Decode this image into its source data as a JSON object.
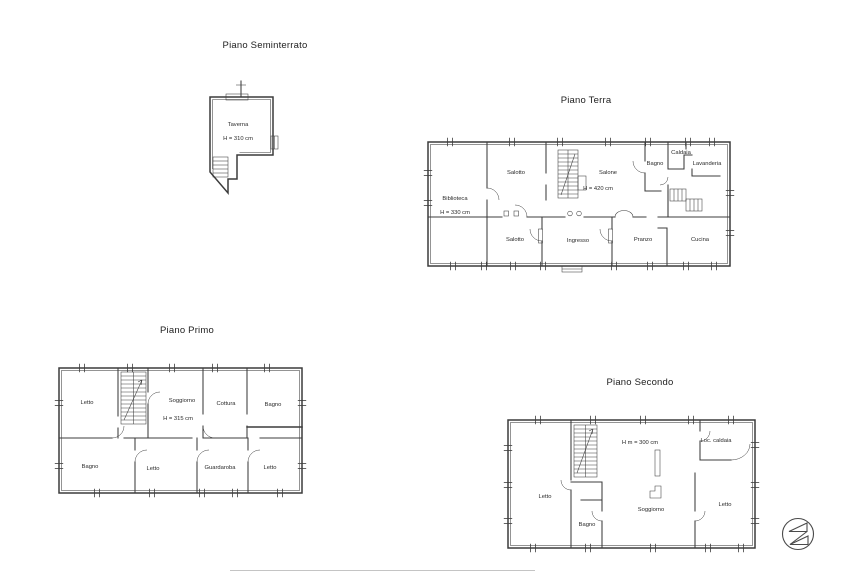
{
  "colors": {
    "line": "#3c3c3c",
    "text": "#2a2a2a",
    "background": "#ffffff"
  },
  "plans": {
    "seminterrato": {
      "title": "Piano Seminterrato",
      "rooms": {
        "taverna": {
          "label": "Taverna",
          "height": "H = 310 cm"
        }
      }
    },
    "terra": {
      "title": "Piano Terra",
      "rooms": {
        "biblioteca": {
          "label": "Biblioteca",
          "height": "H = 330 cm"
        },
        "salotto_nord": {
          "label": "Salotto"
        },
        "salone": {
          "label": "Salone",
          "height": "H = 420 cm"
        },
        "bagno": {
          "label": "Bagno"
        },
        "caldaia": {
          "label": "Caldaia"
        },
        "lavanderia": {
          "label": "Lavanderia"
        },
        "salotto_sud": {
          "label": "Salotto"
        },
        "ingresso": {
          "label": "Ingresso"
        },
        "pranzo": {
          "label": "Pranzo"
        },
        "cucina": {
          "label": "Cucina"
        }
      }
    },
    "primo": {
      "title": "Piano Primo",
      "rooms": {
        "letto_nw": {
          "label": "Letto"
        },
        "soggiorno": {
          "label": "Soggiorno",
          "height": "H = 315 cm"
        },
        "cottura": {
          "label": "Cottura"
        },
        "bagno_ne": {
          "label": "Bagno"
        },
        "bagno_sw": {
          "label": "Bagno"
        },
        "letto_s": {
          "label": "Letto"
        },
        "guardaroba": {
          "label": "Guardaroba"
        },
        "letto_se": {
          "label": "Letto"
        }
      }
    },
    "secondo": {
      "title": "Piano Secondo",
      "rooms": {
        "letto_w": {
          "label": "Letto"
        },
        "bagno": {
          "label": "Bagno"
        },
        "soggiorno": {
          "label": "Soggiorno",
          "height": "H m = 300 cm"
        },
        "loc_caldaia": {
          "label": "Loc. caldaia"
        },
        "letto_e": {
          "label": "Letto"
        }
      }
    }
  },
  "logo": {
    "icon": "compass-arrows-logo"
  }
}
